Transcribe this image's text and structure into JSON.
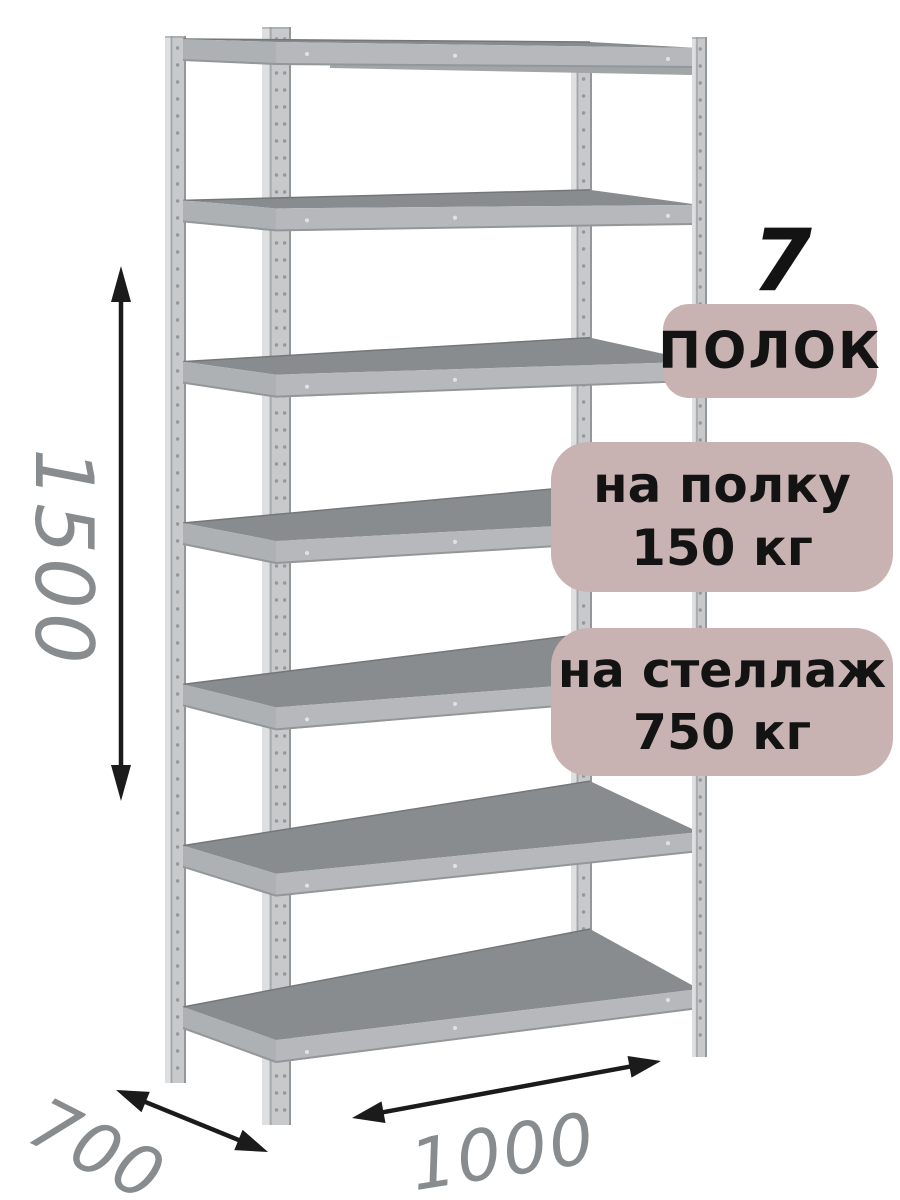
{
  "product": {
    "shelf_count": 7
  },
  "dimensions": {
    "height": "1500",
    "depth": "700",
    "width": "1000"
  },
  "badges": {
    "count_number": "7",
    "count_label": "ПОЛОК",
    "per_shelf_line1": "на полку",
    "per_shelf_line2": "150 кг",
    "per_rack_line1": "на стеллаж",
    "per_rack_line2": "750 кг"
  },
  "palette": {
    "background": "#ffffff",
    "badge_bg": "#c9b3b2",
    "badge_text": "#131313",
    "dim_text": "#888c8f",
    "arrow": "#1b1b1b",
    "shelf_top": "#898c8f",
    "shelf_top_back_edge": "#74777a",
    "shelf_edge": "#b6b8bb",
    "shelf_edge_side": "#aeb1b4",
    "shelf_edge_dark": "#94979a",
    "rivet": "#dfe1e3",
    "post_face": "#c7c9cb",
    "post_light": "#dddfe0",
    "post_seam": "#a3a6a9",
    "post_dark": "#94979a",
    "post_hole": "#8f9295",
    "back_beam": "#a2a5a8"
  }
}
